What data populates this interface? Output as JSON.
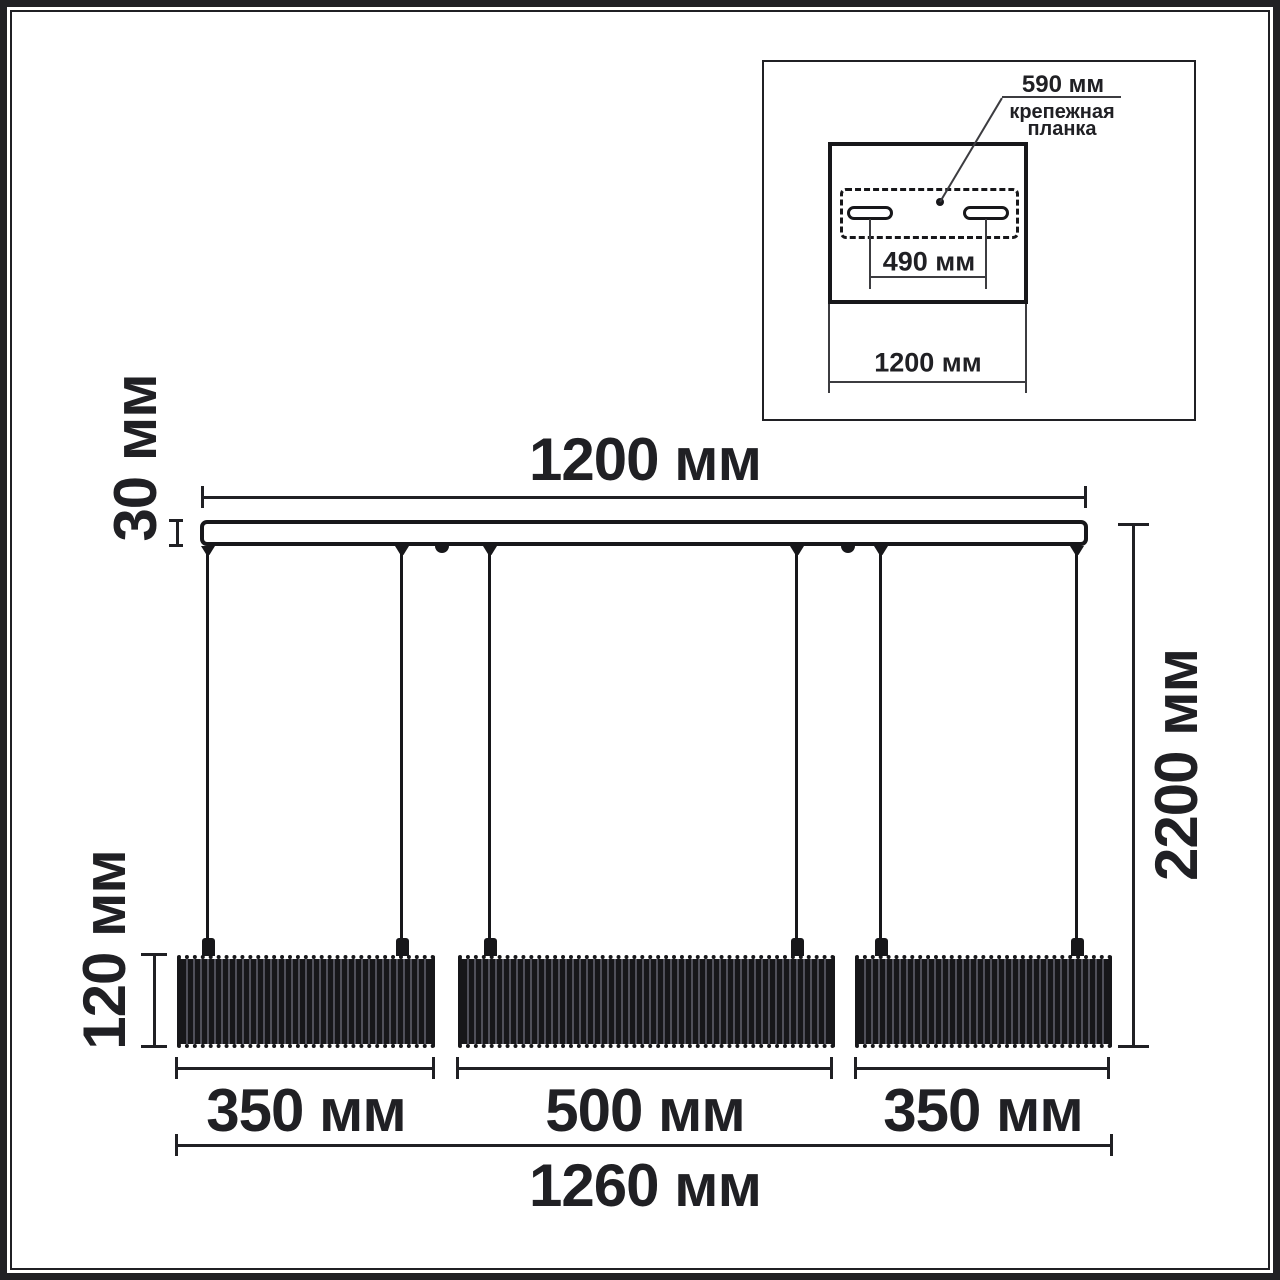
{
  "colors": {
    "ink": "#202024",
    "thin_line": "#3c3c40",
    "shade_base": "#17171a",
    "shade_stripe": "#50505a",
    "background": "#ffffff"
  },
  "inset": {
    "plate_width_label": "590 мм",
    "plate_name_line1": "крепежная",
    "plate_name_line2": "планка",
    "slot_spacing_label": "490 мм",
    "canopy_width_label": "1200 мм"
  },
  "main": {
    "rail_width_label": "1200 мм",
    "rail_thickness_label": "30 мм",
    "shade_height_label": "120 мм",
    "total_drop_label": "2200 мм",
    "shade_left_width_label": "350 мм",
    "shade_center_width_label": "500 мм",
    "shade_right_width_label": "350 мм",
    "overall_width_label": "1260 мм"
  },
  "dimensions_mm": {
    "rail_width": 1200,
    "rail_thickness": 30,
    "shade_height": 120,
    "total_drop": 2200,
    "shade_widths": [
      350,
      500,
      350
    ],
    "overall_width": 1260,
    "canopy_width": 1200,
    "slot_spacing": 490,
    "plate_width": 590
  }
}
